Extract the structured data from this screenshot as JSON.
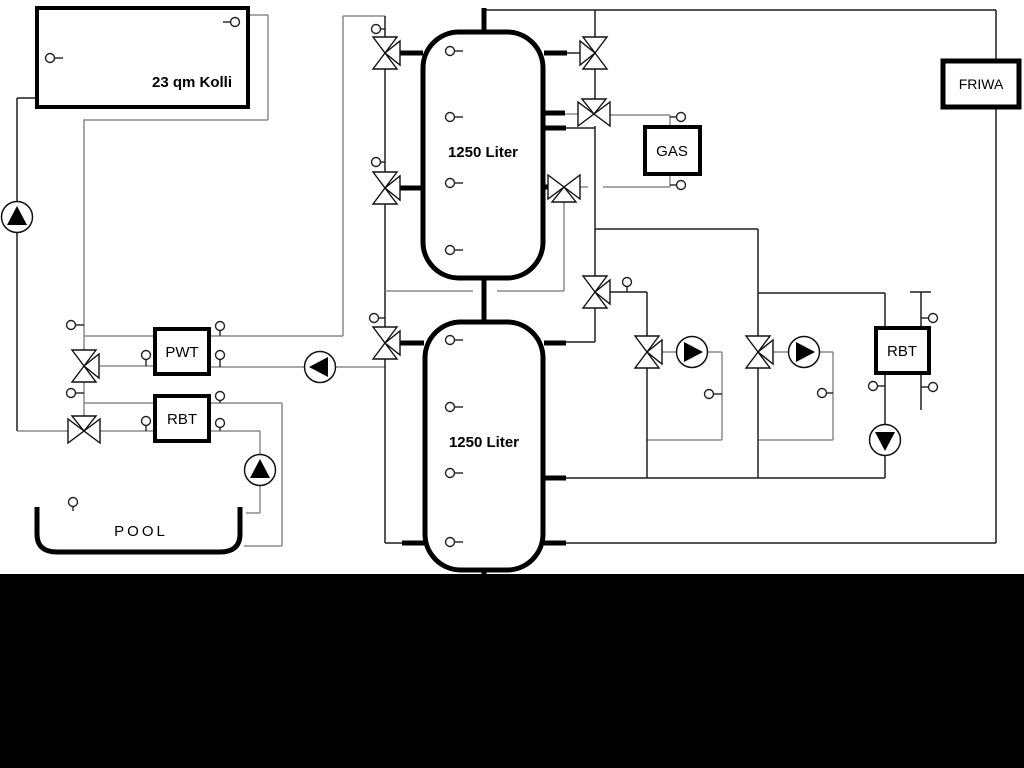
{
  "diagram": {
    "solar_collector": {
      "label": "23 qm Kolli"
    },
    "buffer_tank_top": {
      "label": "1250 Liter"
    },
    "buffer_tank_bottom": {
      "label": "1250 Liter"
    },
    "pool_heat_exchanger": {
      "label": "PWT"
    },
    "pool_return_unit": {
      "label": "RBT"
    },
    "gas_boiler": {
      "label": "GAS"
    },
    "fresh_water_station": {
      "label": "FRIWA"
    },
    "return_unit_right": {
      "label": "RBT"
    },
    "pool": {
      "label": "POOL"
    }
  },
  "colors": {
    "background": "#ffffff",
    "bottom_band": "#000000",
    "pipe_gray": "#8a8a8a",
    "pipe_dark": "#1f1f1f",
    "component_outline": "#000000"
  }
}
